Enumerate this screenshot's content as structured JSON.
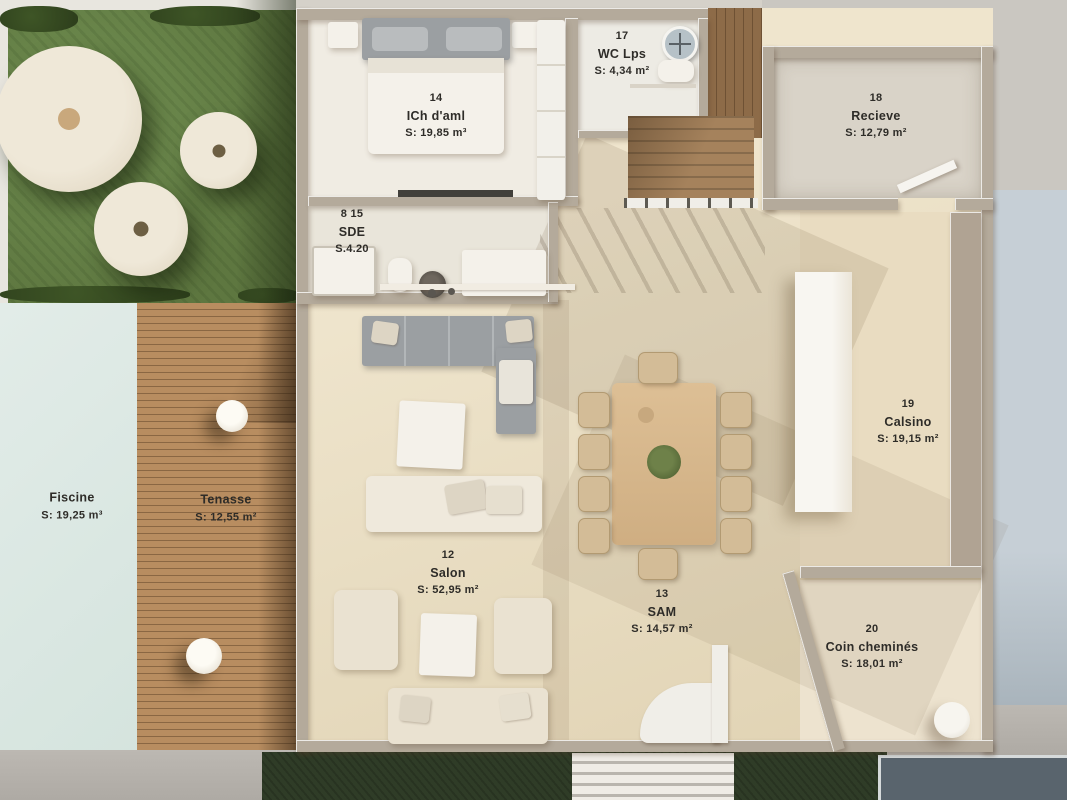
{
  "rooms": [
    {
      "id": "piscine",
      "number": "",
      "name": "Fiscine",
      "area": "S: 19,25 m³"
    },
    {
      "id": "terrasse",
      "number": "",
      "name": "Tenasse",
      "area": "S: 12,55 m²"
    },
    {
      "id": "chambre-ami",
      "number": "14",
      "name": "ICh d'aml",
      "area": "S: 19,85 m³"
    },
    {
      "id": "sde",
      "number": "8 15",
      "name": "SDE",
      "area": "S.4.20"
    },
    {
      "id": "wc",
      "number": "17",
      "name": "WC Lps",
      "area": "S: 4,34 m²"
    },
    {
      "id": "recieve",
      "number": "18",
      "name": "Recieve",
      "area": "S: 12,79 m²"
    },
    {
      "id": "cuisine",
      "number": "19",
      "name": "Calsino",
      "area": "S: 19,15 m²"
    },
    {
      "id": "salon",
      "number": "12",
      "name": "Salon",
      "area": "S: 52,95 m²"
    },
    {
      "id": "sam",
      "number": "13",
      "name": "SAM",
      "area": "S: 14,57 m²"
    },
    {
      "id": "coin-cheminee",
      "number": "20",
      "name": "Coin cheminés",
      "area": "S: 18,01 m²"
    }
  ],
  "colors": {
    "pool": "#dbe7e2",
    "deck_wood": "#b68c60",
    "grass": "#5e7740",
    "floor": "#e8ddc4",
    "wall": "#b4aa9b",
    "label_text": "#2e2c28",
    "slate": "#59646d",
    "paving": "#b3afa9",
    "exterior_blue": "#c2cbd3"
  }
}
